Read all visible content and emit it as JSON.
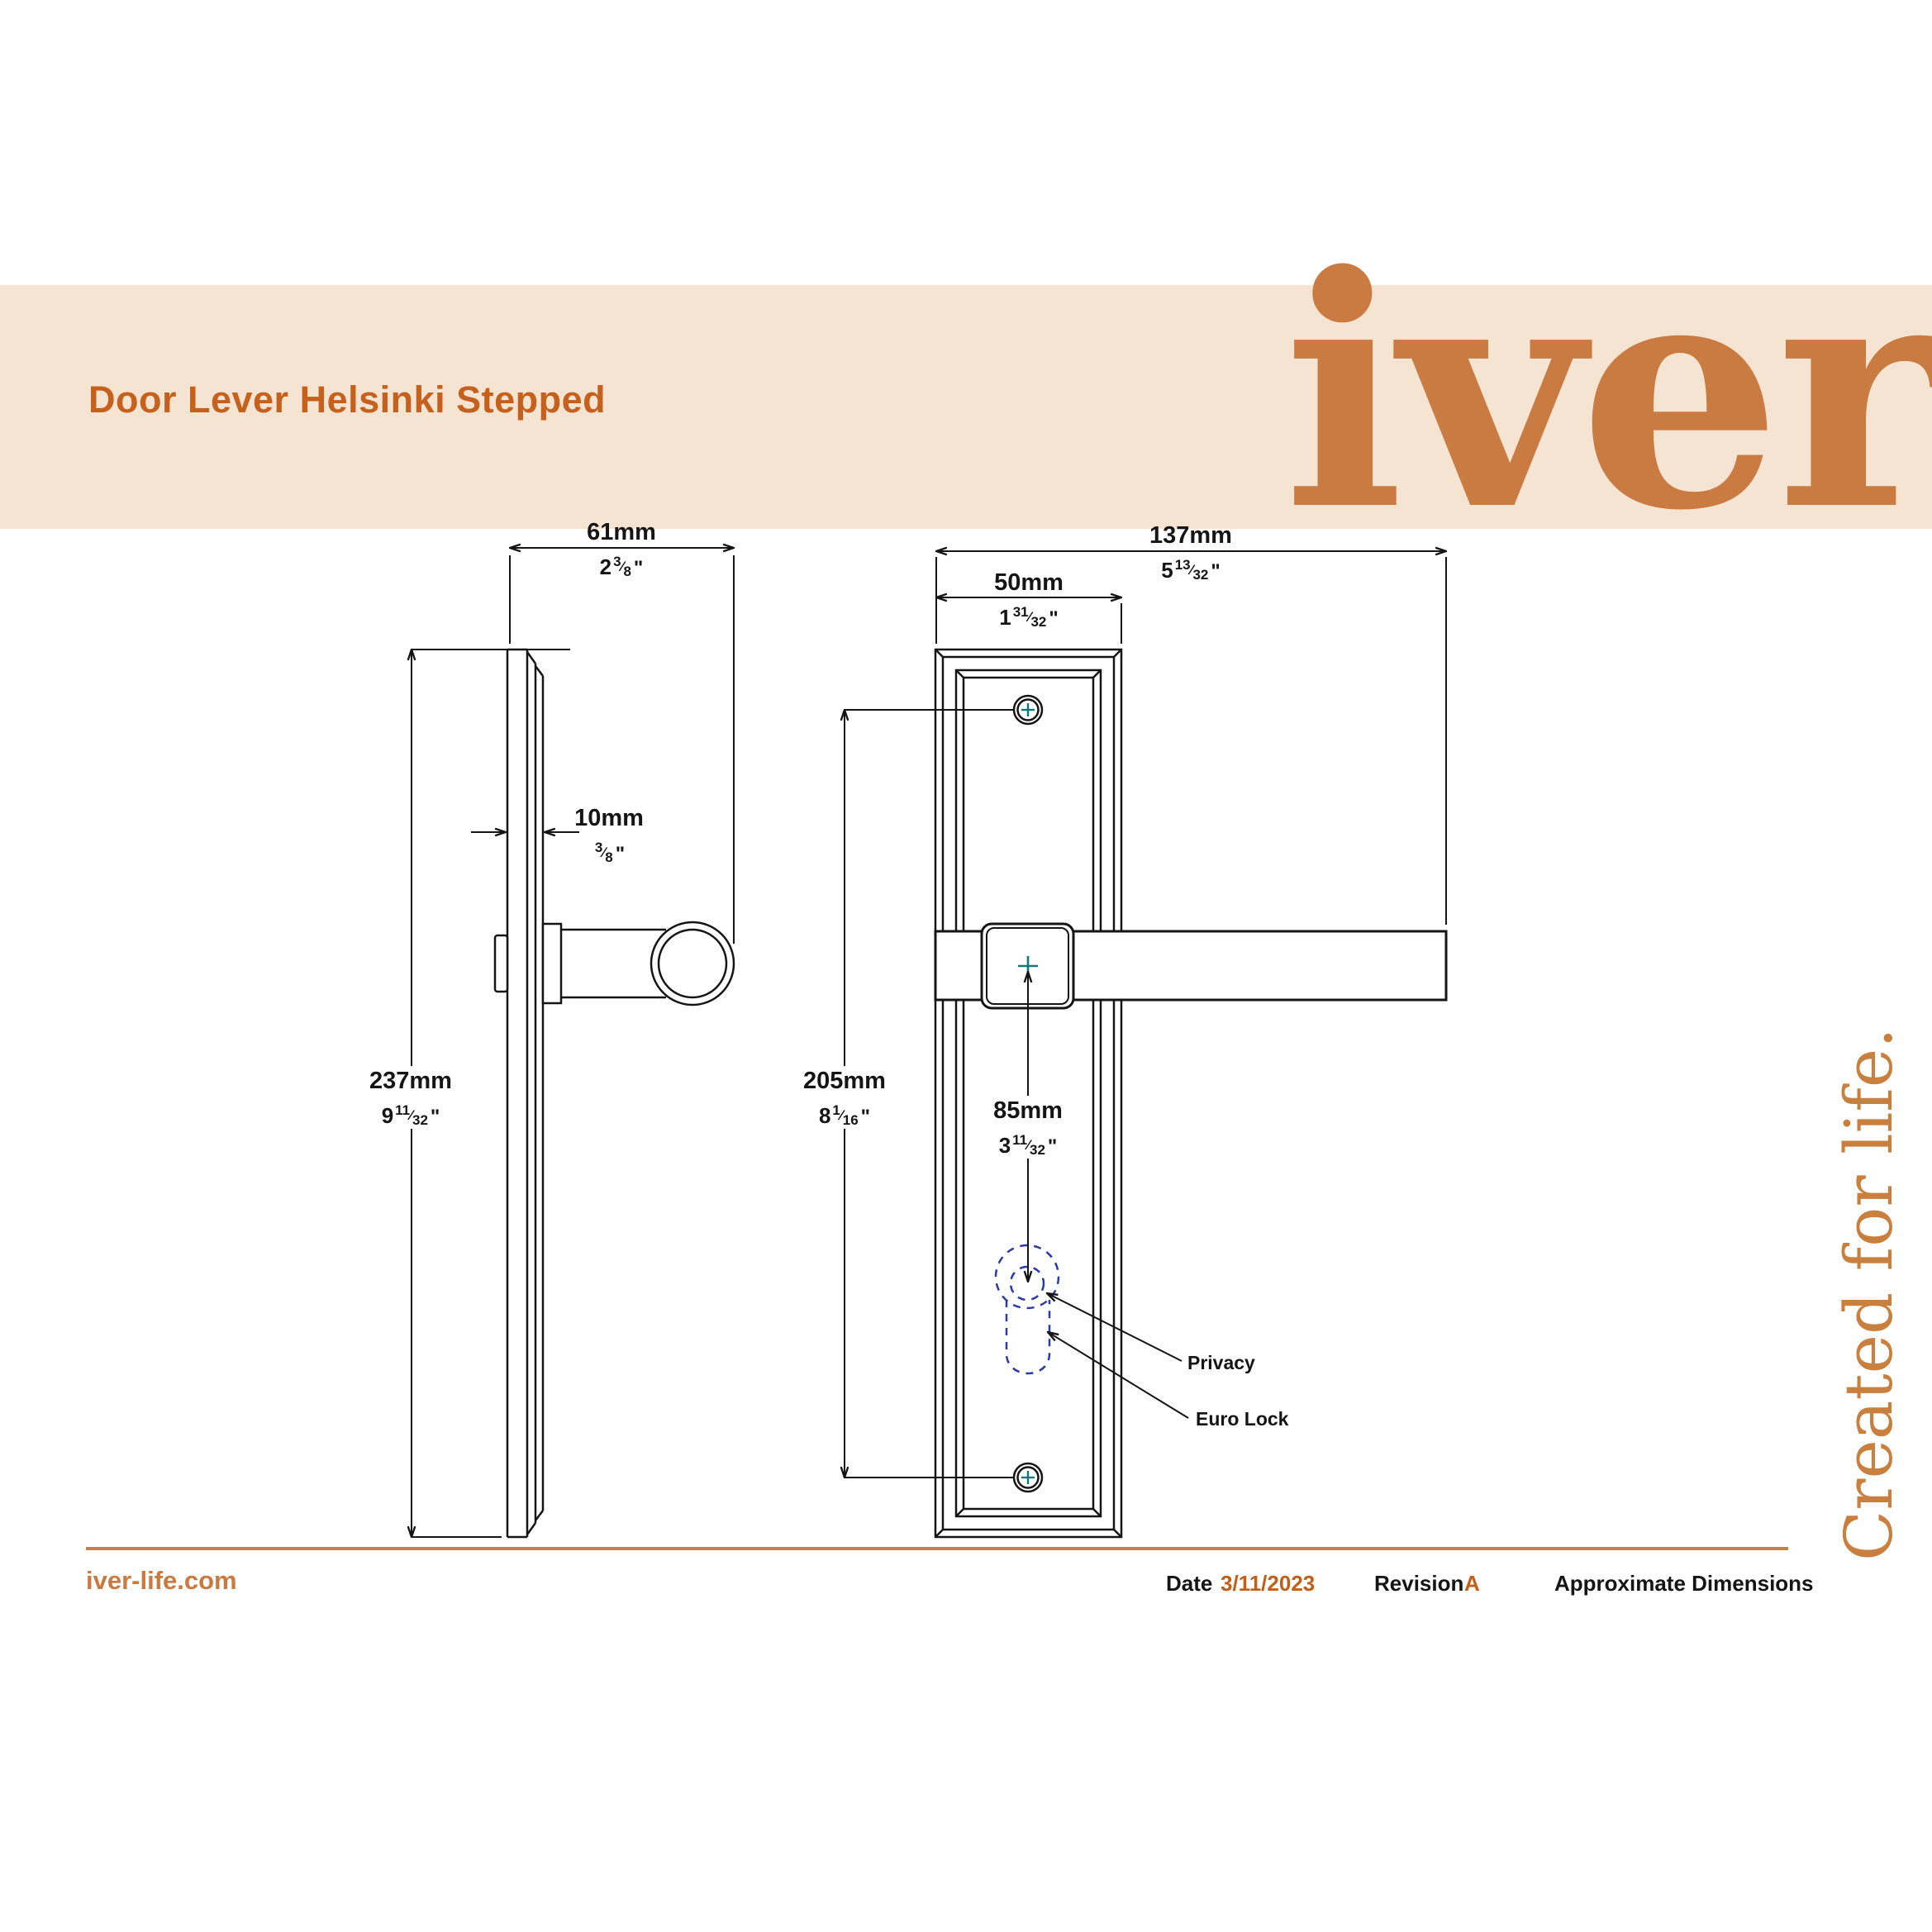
{
  "banner": {
    "title": "Door Lever Helsinki Stepped",
    "logo_text": "iver"
  },
  "tagline": {
    "text": "Created for life."
  },
  "glyphs": {
    "fraction_slash": "⁄",
    "inch_mark": "\""
  },
  "colors": {
    "banner_bg": "#F6E4D3",
    "title_orange": "#C6601D",
    "brand_orange": "#C97B42",
    "rule_orange": "#C9803E",
    "line_black": "#151515",
    "keyhole_dashed_blue": "#2B3AA5",
    "screw_cross_teal": "#0A7A7F"
  },
  "drawing": {
    "labels": {
      "privacy": "Privacy",
      "euro_lock": "Euro Lock"
    },
    "dims": {
      "depth": {
        "mm": "61mm",
        "whole": "2",
        "num": "3",
        "den": "8"
      },
      "thickness": {
        "mm": "10mm",
        "whole": "",
        "num": "3",
        "den": "8"
      },
      "height": {
        "mm": "237mm",
        "whole": "9",
        "num": "11",
        "den": "32"
      },
      "length": {
        "mm": "137mm",
        "whole": "5",
        "num": "13",
        "den": "32"
      },
      "plate_width": {
        "mm": "50mm",
        "whole": "1",
        "num": "31",
        "den": "32"
      },
      "screw_centres": {
        "mm": "205mm",
        "whole": "8",
        "num": "1",
        "den": "16"
      },
      "handle_to_keyhole": {
        "mm": "85mm",
        "whole": "3",
        "num": "11",
        "den": "32"
      }
    }
  },
  "footer": {
    "website": "iver-life.com",
    "date_label": "Date",
    "date_value": "3/11/2023",
    "revision_label": "Revision",
    "revision_value": "A",
    "note": "Approximate Dimensions"
  }
}
